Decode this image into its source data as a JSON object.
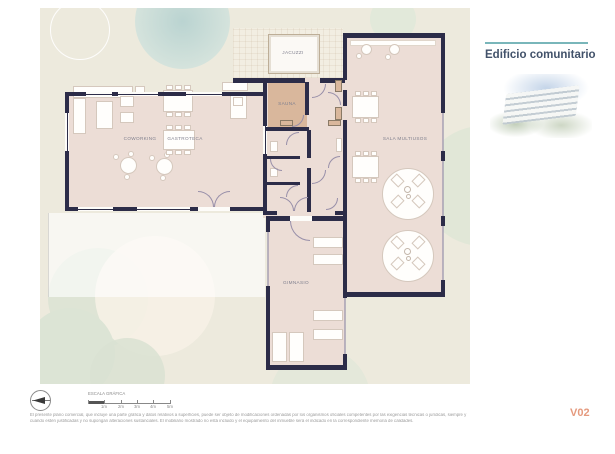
{
  "sidebar": {
    "title": "Edificio comunitario"
  },
  "plan": {
    "rooms": {
      "coworking": "COWORKING",
      "gastroteca": "GASTROTECA",
      "sauna": "SAUNA",
      "jacuzzi": "JACUZZI",
      "sala_multiusos": "SALA MULTIUSOS",
      "gimnasio": "GIMNASIO"
    }
  },
  "footer": {
    "scale_label": "ESCALA GRÁFICA",
    "scale_ticks": [
      "1m",
      "2m",
      "3m",
      "4m",
      "5m"
    ],
    "disclaimer_line1": "El presente plano comercial, que incluye una parte gráfica y datos relativos a superficies, puede ser objeto de modificaciones ordenadas por los organismos oficiales competentes por las exigencias técnicas o jurídicas, siempre y",
    "disclaimer_line2": "cuando estén justificadas y no supongan alteraciones sustanciales. El mobiliario mostrado no está incluido y el equipamiento del inmueble será el indicado en la correspondiente memoria de calidades.",
    "version": "V02"
  },
  "colors": {
    "wall_navy": "#2c2c48",
    "floor_pink": "#ecddd6",
    "sauna_tan": "#d9b79c",
    "panel_beige": "#edeadd",
    "accent_teal": "#79b6ba",
    "version_orange": "#e59a7e"
  }
}
